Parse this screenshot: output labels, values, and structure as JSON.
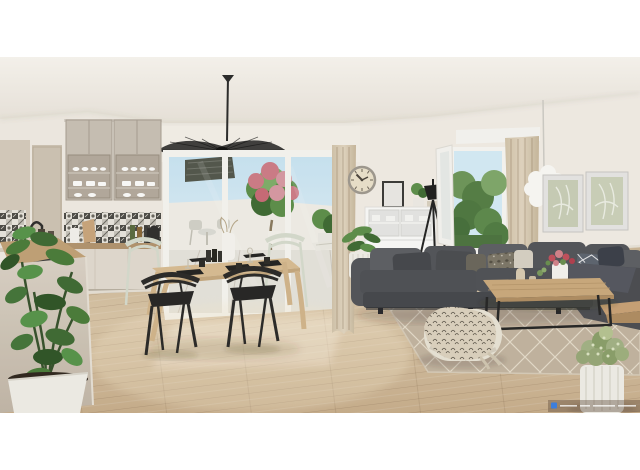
{
  "meta": {
    "description": "3D architectural rendering of a bright open-plan apartment: kitchen with patterned tile backsplash on the left, wooden dining table with black and sage chairs under a black vertigo pendant lamp, sliding glass doors opening to a sunny terrace with a pink flowering tree, and a dark grey corner sofa with coffee table, rug and plants on the right near an open window with beige curtains.",
    "format": "letterboxed photograph, white bars top and bottom"
  },
  "scene": {
    "ceiling": {
      "label": "white ceiling"
    },
    "pendant": {
      "label": "black vertigo pendant lamp"
    },
    "kitchen_cabinets": {
      "label": "taupe wall cabinets with frosted glass and white dishes"
    },
    "backsplash": {
      "label": "black and white patchwork tile backsplash"
    },
    "kitchen_counter": {
      "label": "wood worktop with faucet, bottles and kettle"
    },
    "island": {
      "label": "foreground kitchen island with dark cooktop"
    },
    "plant_left": {
      "label": "large green houseplant in white square pot"
    },
    "dining": {
      "label": "wooden dining table set with black placemats and cups"
    },
    "chairs_black": {
      "label": "two black dining chairs"
    },
    "chairs_sage": {
      "label": "two pale sage dining chairs"
    },
    "sliding_door": {
      "label": "white sliding glass doors"
    },
    "terrace": {
      "label": "terrace with flowering tree, outdoor furniture and blue sky"
    },
    "curtain_center": {
      "label": "beige curtain beside sliding door"
    },
    "clock": {
      "label": "round vintage wall clock"
    },
    "sideboard": {
      "label": "white glass-front sideboard with frame and plant on top"
    },
    "floor_plant_mid": {
      "label": "potted plant beside sideboard"
    },
    "tripod_lamp": {
      "label": "black tripod floor lamp"
    },
    "window_right": {
      "label": "open white window with trees outside"
    },
    "curtain_right": {
      "label": "beige curtain on right window"
    },
    "pompom_lamp": {
      "label": "white pompom pendant lamp"
    },
    "prints": {
      "label": "two sage botanical wall prints"
    },
    "sofa": {
      "label": "dark grey corner sofa with patterned cushions"
    },
    "coffee_table": {
      "label": "wood and black metal coffee table with flowers"
    },
    "rug": {
      "label": "beige rug with white diamond lattice"
    },
    "pouf": {
      "label": "cream pouf with leaf-print throw"
    },
    "plant_right": {
      "label": "bushy green plant in round white planter"
    },
    "wood_bench": {
      "label": "small wooden side bench"
    },
    "floor": {
      "label": "light oak plank floor"
    },
    "watermark": {
      "label": "tiny illegible photo-credit watermark",
      "legible": false,
      "position": "bottom-right"
    }
  },
  "colors": {
    "letterbox": "#ffffff",
    "wall": "#f1ece4",
    "wall_right": "#f3eee7",
    "ceiling_top": "#f9f6f1",
    "ceiling_bottom": "#ebe5dc",
    "floor_light": "#dcc8aa",
    "floor_dark": "#c1a браз888",
    "cab_upper": "#c9c1b6",
    "cab_glass": "#b5aa9e",
    "cab_base": "#e2dbd1",
    "counter_wood": "#b2946f",
    "island_light": "#dcd3c7",
    "island_dark": "#c6bcae",
    "tile_dark": "#4b4a46",
    "tile_light": "#eae6df",
    "door_frame": "#f7f6f2",
    "sky_top": "#c9e5f4",
    "sky_bottom": "#eef7fb",
    "terrace_wall": "#f2efe9",
    "terrace_floor": "#e7e4dd",
    "awning": "#53574c",
    "foliage_dark": "#3f6b33",
    "foliage_mid": "#5d8f4a",
    "foliage_light": "#7fae6a",
    "flower_pink": "#cf7c88",
    "flower_red": "#c2505c",
    "curtain": "#dbcdb6",
    "curtain_fold": "#c3b296",
    "clock_face": "#ece2cc",
    "clock_rim": "#a09a90",
    "sideboard": "#fbfbfa",
    "sofa": "#53555a",
    "sofa_dark": "#45474c",
    "sofa_light": "#5d5f64",
    "cushion_cream": "#d8d2c5",
    "cushion_slate": "#5d6470",
    "cushion_leaf": "#7d7769",
    "table_wood": "#d9bd93",
    "chair_black": "#2a2928",
    "chair_sage": "#e3e7dd",
    "coffee_wood": "#cbaa7d",
    "metal_black": "#262626",
    "rug": "#c3b5a1",
    "rug_line": "#ece4d3",
    "pouf": "#eae4d7",
    "throw": "#ddd3c0",
    "pot_white": "#f1efe9",
    "bush_green": "#a3b286",
    "pelmet": "#f7f6f3",
    "print_bg": "#c9cfb8",
    "print_line": "#eef0e6",
    "frame_gray": "#e8e7e5",
    "pompom": "#fbfaf7",
    "lamp_black": "#1f1f1f",
    "watermark_blue": "#3d7edb"
  }
}
